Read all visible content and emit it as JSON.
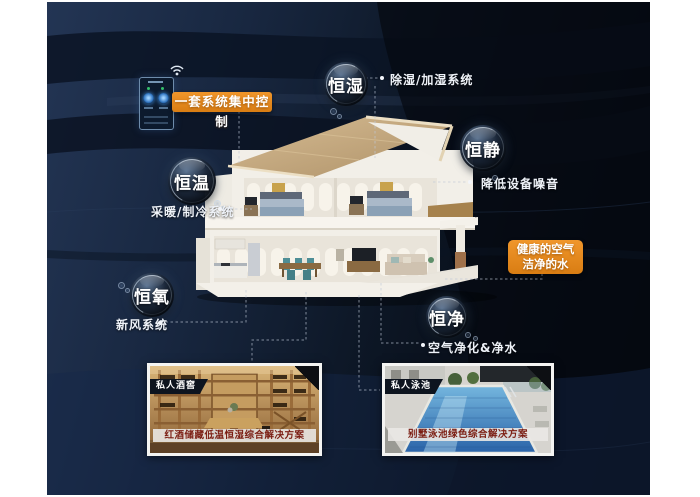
{
  "bubbles": {
    "humidity": {
      "name": "恒湿",
      "system": "除湿/加湿系统"
    },
    "quiet": {
      "name": "恒静",
      "system": "降低设备噪音"
    },
    "temperature": {
      "name": "恒温",
      "system": "采暖/制冷系统"
    },
    "oxygen": {
      "name": "恒氧",
      "system": "新风系统"
    },
    "purity": {
      "name": "恒净",
      "system": "空气净化&净水"
    }
  },
  "callouts": {
    "central_control": "一套系统集中控制",
    "healthy_air": "健康的空气",
    "clean_water": "洁净的水"
  },
  "cards": {
    "wine_cellar": {
      "badge": "私人酒窖",
      "caption": "红酒储藏低温恒湿综合解决方案"
    },
    "pool": {
      "badge": "私人泳池",
      "caption": "别墅泳池绿色综合解决方案"
    }
  },
  "icons": {
    "wifi": "svg-arcs",
    "connector_dot": "css-circle"
  },
  "colors": {
    "accent_orange": "#e6871d",
    "background_navy": "#15233b",
    "caption_red": "#7b1d12",
    "pool_blue": "#3f80bf",
    "roof_tan": "#c8ad85",
    "bubble_ring": "#cfe2f4"
  }
}
